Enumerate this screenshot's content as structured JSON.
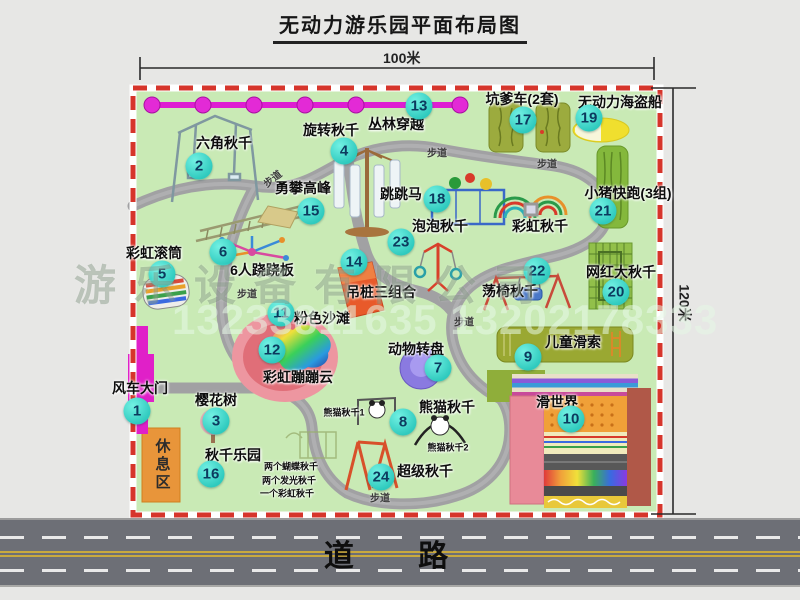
{
  "title": "无动力游乐园平面布局图",
  "dimensions": {
    "width_label": "100米",
    "height_label": "120米"
  },
  "road": {
    "label": "道  路"
  },
  "watermark": {
    "company": "游乐设备有限公司",
    "phone": "13233811635 13202178333"
  },
  "colors": {
    "map_green": "#c9eab5",
    "border_red": "#d6352b",
    "badge_teal": "#2fcabe",
    "gate_magenta": "#e020c8",
    "chain_magenta": "#de1ed2",
    "path_gray": "#a1a1a3",
    "rest_orange": "#e8953a",
    "road_gray": "#6d6f76"
  },
  "map": {
    "rest_area_label": "休息区",
    "facilities": [
      {
        "num": "1",
        "label": "风车大门",
        "bx": 137,
        "by": 411,
        "lx": 140,
        "ly": 388
      },
      {
        "num": "2",
        "label": "六角秋千",
        "bx": 199,
        "by": 166,
        "lx": 224,
        "ly": 143
      },
      {
        "num": "3",
        "label": "樱花树",
        "bx": 216,
        "by": 421,
        "lx": 216,
        "ly": 400
      },
      {
        "num": "4",
        "label": "旋转秋千",
        "bx": 344,
        "by": 151,
        "lx": 331,
        "ly": 130
      },
      {
        "num": "5",
        "label": "彩虹滚筒",
        "bx": 162,
        "by": 274,
        "lx": 154,
        "ly": 253
      },
      {
        "num": "6",
        "label": "6人跷跷板",
        "bx": 223,
        "by": 252,
        "lx": 262,
        "ly": 270
      },
      {
        "num": "7",
        "label": "动物转盘",
        "bx": 438,
        "by": 368,
        "lx": 416,
        "ly": 349
      },
      {
        "num": "8",
        "label": "熊猫秋千",
        "bx": 403,
        "by": 422,
        "lx": 447,
        "ly": 407
      },
      {
        "num": "9",
        "label": "儿童滑索",
        "bx": 528,
        "by": 357,
        "lx": 573,
        "ly": 342
      },
      {
        "num": "10",
        "label": "滑世界",
        "bx": 571,
        "by": 419,
        "lx": 557,
        "ly": 402
      },
      {
        "num": "11",
        "label": "粉色沙滩",
        "bx": 281,
        "by": 313,
        "lx": 322,
        "ly": 318
      },
      {
        "num": "12",
        "label": "彩虹蹦蹦云",
        "bx": 272,
        "by": 350,
        "lx": 298,
        "ly": 377
      },
      {
        "num": "13",
        "label": "丛林穿越",
        "bx": 419,
        "by": 106,
        "lx": 396,
        "ly": 124
      },
      {
        "num": "14",
        "label": "吊桩三组合",
        "bx": 354,
        "by": 262,
        "lx": 381,
        "ly": 292
      },
      {
        "num": "15",
        "label": "勇攀高峰",
        "bx": 311,
        "by": 211,
        "lx": 303,
        "ly": 188
      },
      {
        "num": "16",
        "label": "秋千乐园",
        "bx": 211,
        "by": 474,
        "lx": 233,
        "ly": 455
      },
      {
        "num": "17",
        "label": "坑爹车(2套)",
        "bx": 523,
        "by": 120,
        "lx": 522,
        "ly": 99
      },
      {
        "num": "18",
        "label": "跳跳马",
        "bx": 437,
        "by": 199,
        "lx": 401,
        "ly": 194
      },
      {
        "num": "19",
        "label": "无动力海盗船",
        "bx": 589,
        "by": 118,
        "lx": 620,
        "ly": 102
      },
      {
        "num": "20",
        "label": "网红大秋千",
        "bx": 616,
        "by": 292,
        "lx": 621,
        "ly": 272
      },
      {
        "num": "21",
        "label": "小猪快跑(3组)",
        "bx": 603,
        "by": 211,
        "lx": 628,
        "ly": 193
      },
      {
        "num": "22",
        "label": "荡椅秋千",
        "bx": 537,
        "by": 271,
        "lx": 510,
        "ly": 291
      },
      {
        "num": "23",
        "label": "泡泡秋千",
        "bx": 401,
        "by": 242,
        "lx": 440,
        "ly": 226
      },
      {
        "num": "24",
        "label": "超级秋千",
        "bx": 381,
        "by": 477,
        "lx": 425,
        "ly": 471
      }
    ],
    "extra_labels": [
      {
        "text": "彩虹秋千",
        "x": 540,
        "y": 226,
        "cls": "main"
      },
      {
        "text": "熊猫秋千1",
        "x": 344,
        "y": 412,
        "cls": "tiny"
      },
      {
        "text": "熊猫秋千2",
        "x": 448,
        "y": 447,
        "cls": "tiny"
      },
      {
        "text": "两个蝴蝶秋千",
        "x": 291,
        "y": 466,
        "cls": "tiny"
      },
      {
        "text": "两个发光秋千",
        "x": 289,
        "y": 480,
        "cls": "tiny"
      },
      {
        "text": "一个彩虹秋千",
        "x": 287,
        "y": 493,
        "cls": "tiny"
      }
    ],
    "path_labels": [
      {
        "text": "步道",
        "x": 272,
        "y": 178,
        "rot": -38
      },
      {
        "text": "步道",
        "x": 437,
        "y": 152,
        "rot": 0
      },
      {
        "text": "步道",
        "x": 547,
        "y": 163,
        "rot": 0
      },
      {
        "text": "步道",
        "x": 247,
        "y": 293,
        "rot": 0
      },
      {
        "text": "步道",
        "x": 464,
        "y": 321,
        "rot": 0
      },
      {
        "text": "步道",
        "x": 380,
        "y": 497,
        "rot": 0
      }
    ]
  }
}
